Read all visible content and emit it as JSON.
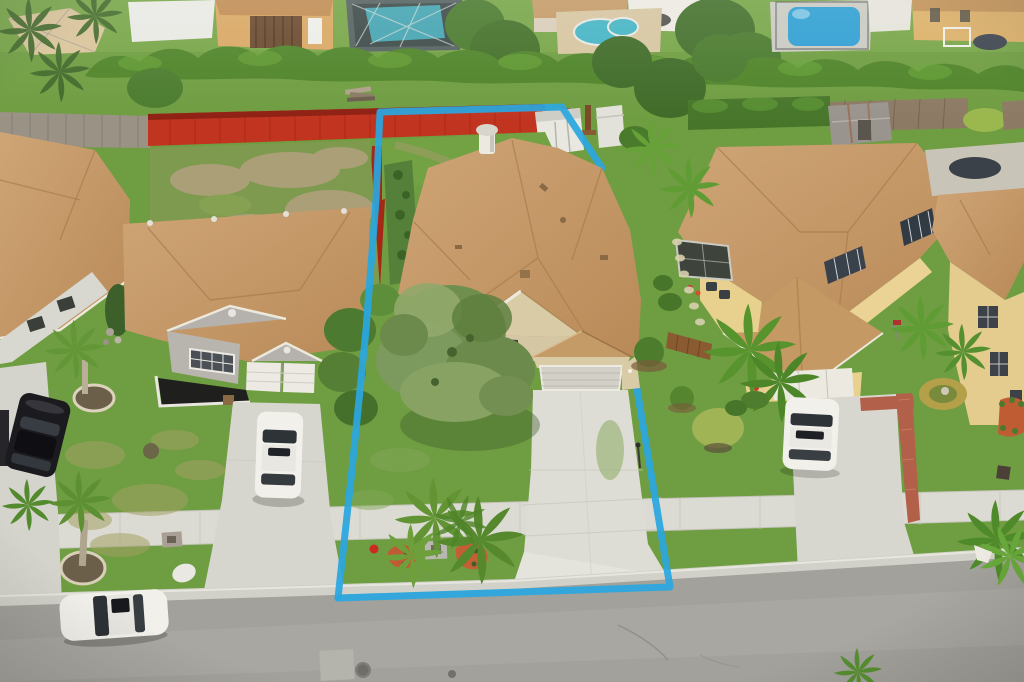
{
  "image": {
    "width": 1024,
    "height": 682,
    "kind": "aerial-drone-photo",
    "description": "Overhead aerial photo of a suburban single-family home lot outlined with a blue property-boundary polygon; tan shingle roofs, red rear fence, white sheds, green lawns, palm trees, concrete driveways and sidewalk, gray street at bottom, neighbor houses on both sides and swimming pools along the top row of backyards."
  },
  "palette": {
    "boundary_blue": "#2aa7e0",
    "roof_tan": "#c79d6b",
    "roof_shadow": "#a87e4e",
    "grass_base": "#6f9d41",
    "grass_light": "#7fae4e",
    "hedge_green": "#4f8429",
    "street_gray": "#a2a19b",
    "concrete": "#dcdbd3",
    "red_fence": "#c13420",
    "pool_teal": "#45b4c4",
    "pool_blue": "#2f9fd2",
    "stucco_beige": "#d9cba6",
    "wall_gray": "#b8b5ae",
    "wall_yellow": "#e8d18e",
    "mulch_red": "#bf5c33",
    "car_black": "#1b1b1f",
    "car_white": "#f1f0ea"
  },
  "boundary": {
    "stroke_width": 7,
    "segments": [
      {
        "name": "left-top-upperRight",
        "points": "338,598 352,470 366,330 376,200 380,112 562,107 602,168"
      },
      {
        "name": "lowerRight-bottom",
        "points": "633,365 670,587 338,598"
      }
    ],
    "note": "boundary line is hidden where it passes behind the subject house roof"
  },
  "objects": {
    "subject_house": "single-story tan shingle hip roof with front gable, beige stucco, white-gray garage door, roof cupola vent",
    "subject_driveway": "light concrete, widens to street apron",
    "back_fence": "bright red painted wood fence along rear and part of left side",
    "sheds": [
      "white shed inside rear corner",
      "white shed outside line",
      "rusty gray shed in right neighbor yard"
    ],
    "pools": [
      "screened teal pool top-left",
      "kidney teal pool top-center",
      "blue pool top-right"
    ],
    "cars": [
      "black sedan far-left driveway",
      "white SUV left neighbor driveway",
      "white sedan parked on street",
      "white sedan right neighbor driveway"
    ],
    "vegetation": [
      "large feathery tree over subject front corner",
      "palm clusters in front yards and parkway",
      "long hedge across rear of all lots",
      "two red mulch beds near sidewalk"
    ],
    "street_details": [
      "manhole cover",
      "concrete patch",
      "asphalt cracks",
      "light gutter and curb line"
    ]
  }
}
